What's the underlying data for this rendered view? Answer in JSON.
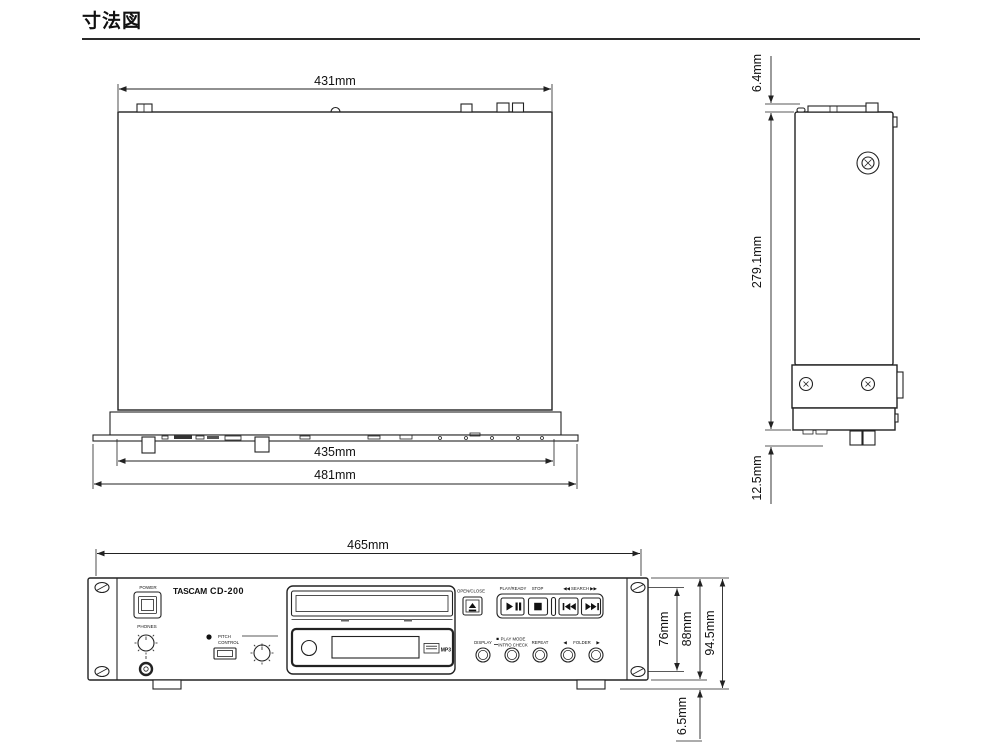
{
  "title": "寸法図",
  "top_view": {
    "dim_width_rear": "431mm",
    "dim_width_front": "435mm",
    "dim_width_total": "481mm"
  },
  "side_view": {
    "dim_top_protrusion": "6.4mm",
    "dim_depth": "279.1mm",
    "dim_bottom_protrusion": "12.5mm"
  },
  "front_view": {
    "dim_width": "465mm",
    "dim_hole_pitch": "76mm",
    "dim_panel_height": "88mm",
    "dim_total_height": "94.5mm",
    "dim_foot_height": "6.5mm",
    "panel": {
      "power": "POWER",
      "brand": "TASCAM",
      "model": "CD-200",
      "phones": "PHONES",
      "pitch_line1": "PITCH",
      "pitch_line2": "CONTROL",
      "open_close": "OPEN/CLOSE",
      "play_ready": "PLAY/READY",
      "stop": "STOP",
      "search": "◀◀ SEARCH ▶▶",
      "display": "DISPLAY",
      "play_mode": "PLAY MODE",
      "intro_check": "INTRO CHECK",
      "repeat": "REPEAT",
      "folder_left": "◀",
      "folder": "FOLDER",
      "folder_right": "▶",
      "mp3": "MP3"
    },
    "icons": {
      "eject": "eject-icon",
      "play_pause": "play-pause-icon",
      "stop": "stop-square-icon",
      "search_rew": "rewind-icon",
      "search_fwd": "fast-forward-icon",
      "pitch_led": "led-dot-icon",
      "rack_hole": "rack-screw-hole-icon",
      "screw": "crosshead-screw-icon",
      "disc_logo": "compact-disc-logo-icon"
    }
  }
}
